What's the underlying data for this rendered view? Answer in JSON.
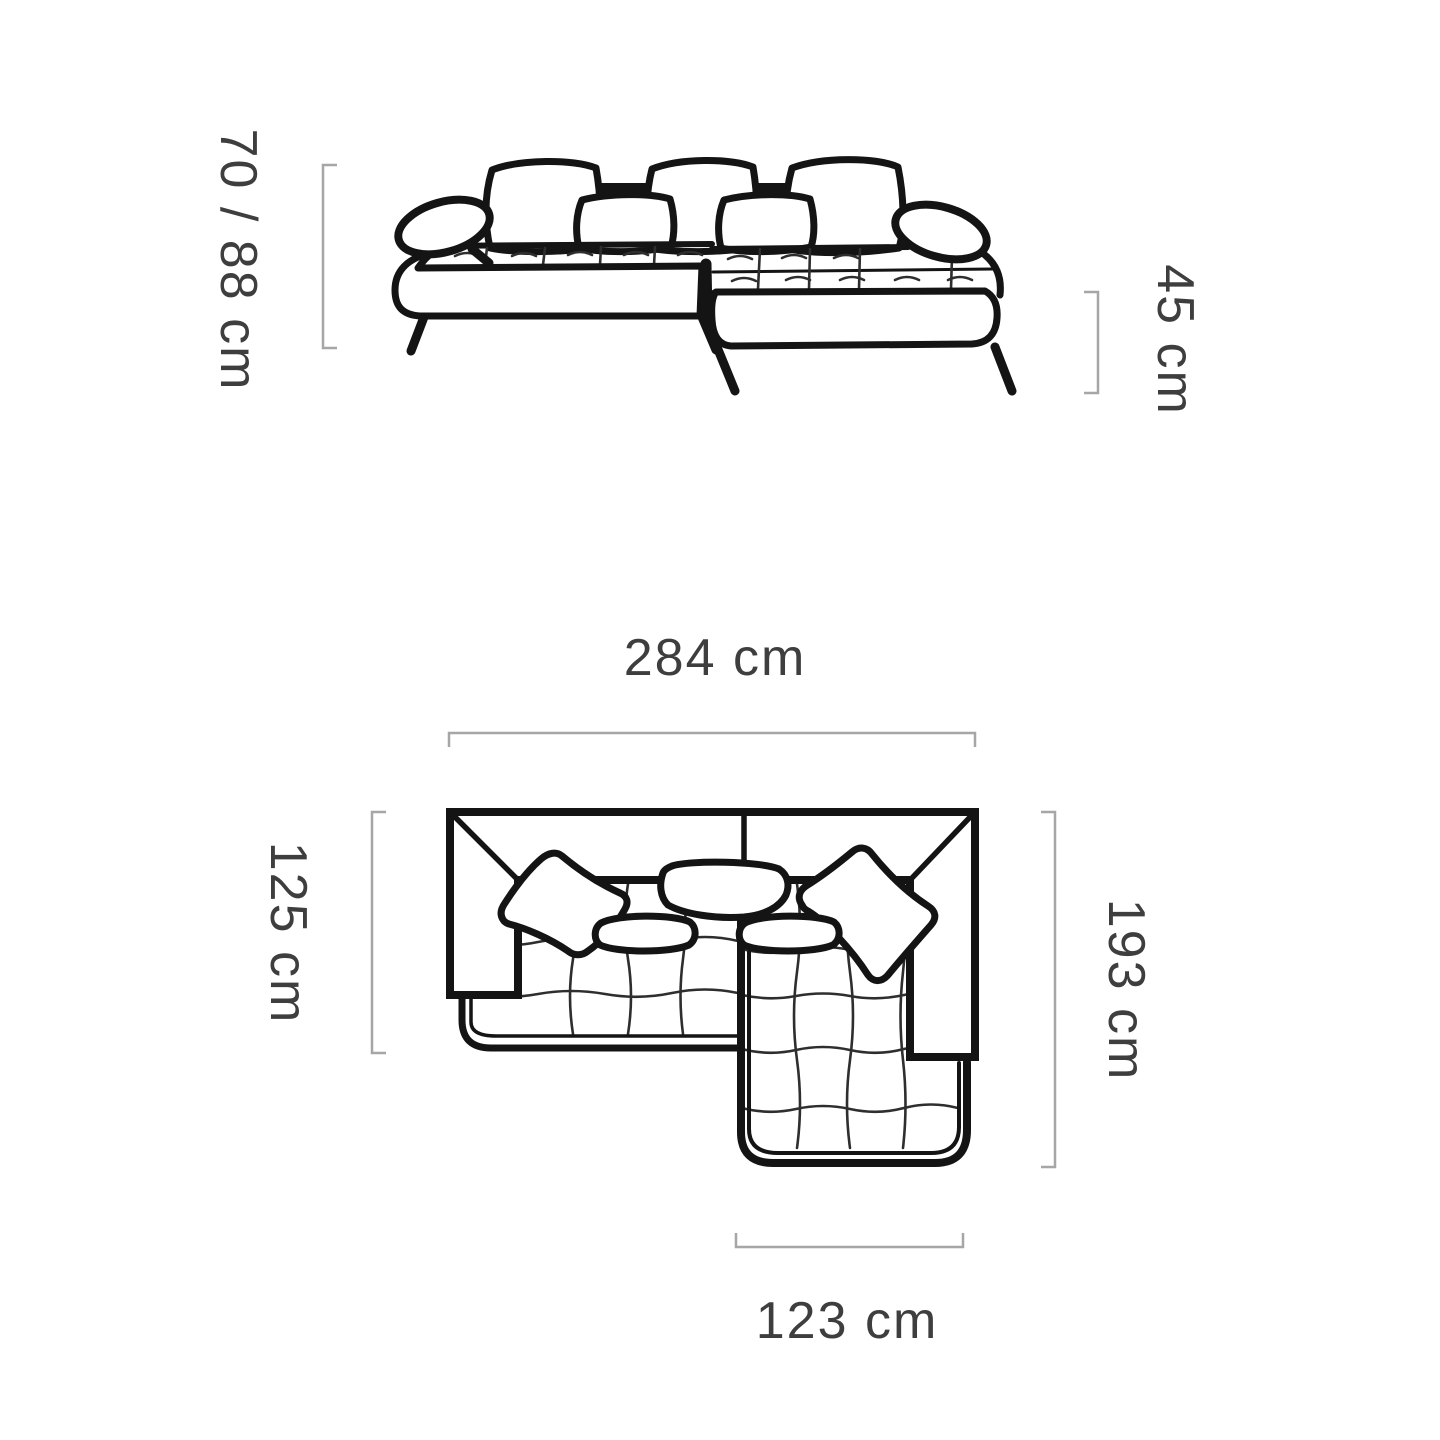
{
  "diagram_type": "sofa-dimension-drawing",
  "colors": {
    "background": "#ffffff",
    "line_art": "#141414",
    "bracket": "#a6a6a6",
    "label_text": "#3e3e3e"
  },
  "dimensions": [
    {
      "id": "front-height",
      "label": "70 / 88 cm",
      "orientation": "vertical"
    },
    {
      "id": "seat-height",
      "label": "45 cm",
      "orientation": "vertical"
    },
    {
      "id": "overall-width",
      "label": "284 cm",
      "orientation": "horizontal"
    },
    {
      "id": "left-depth",
      "label": "125 cm",
      "orientation": "vertical"
    },
    {
      "id": "right-depth",
      "label": "193 cm",
      "orientation": "vertical"
    },
    {
      "id": "chaise-width",
      "label": "123 cm",
      "orientation": "horizontal"
    }
  ]
}
